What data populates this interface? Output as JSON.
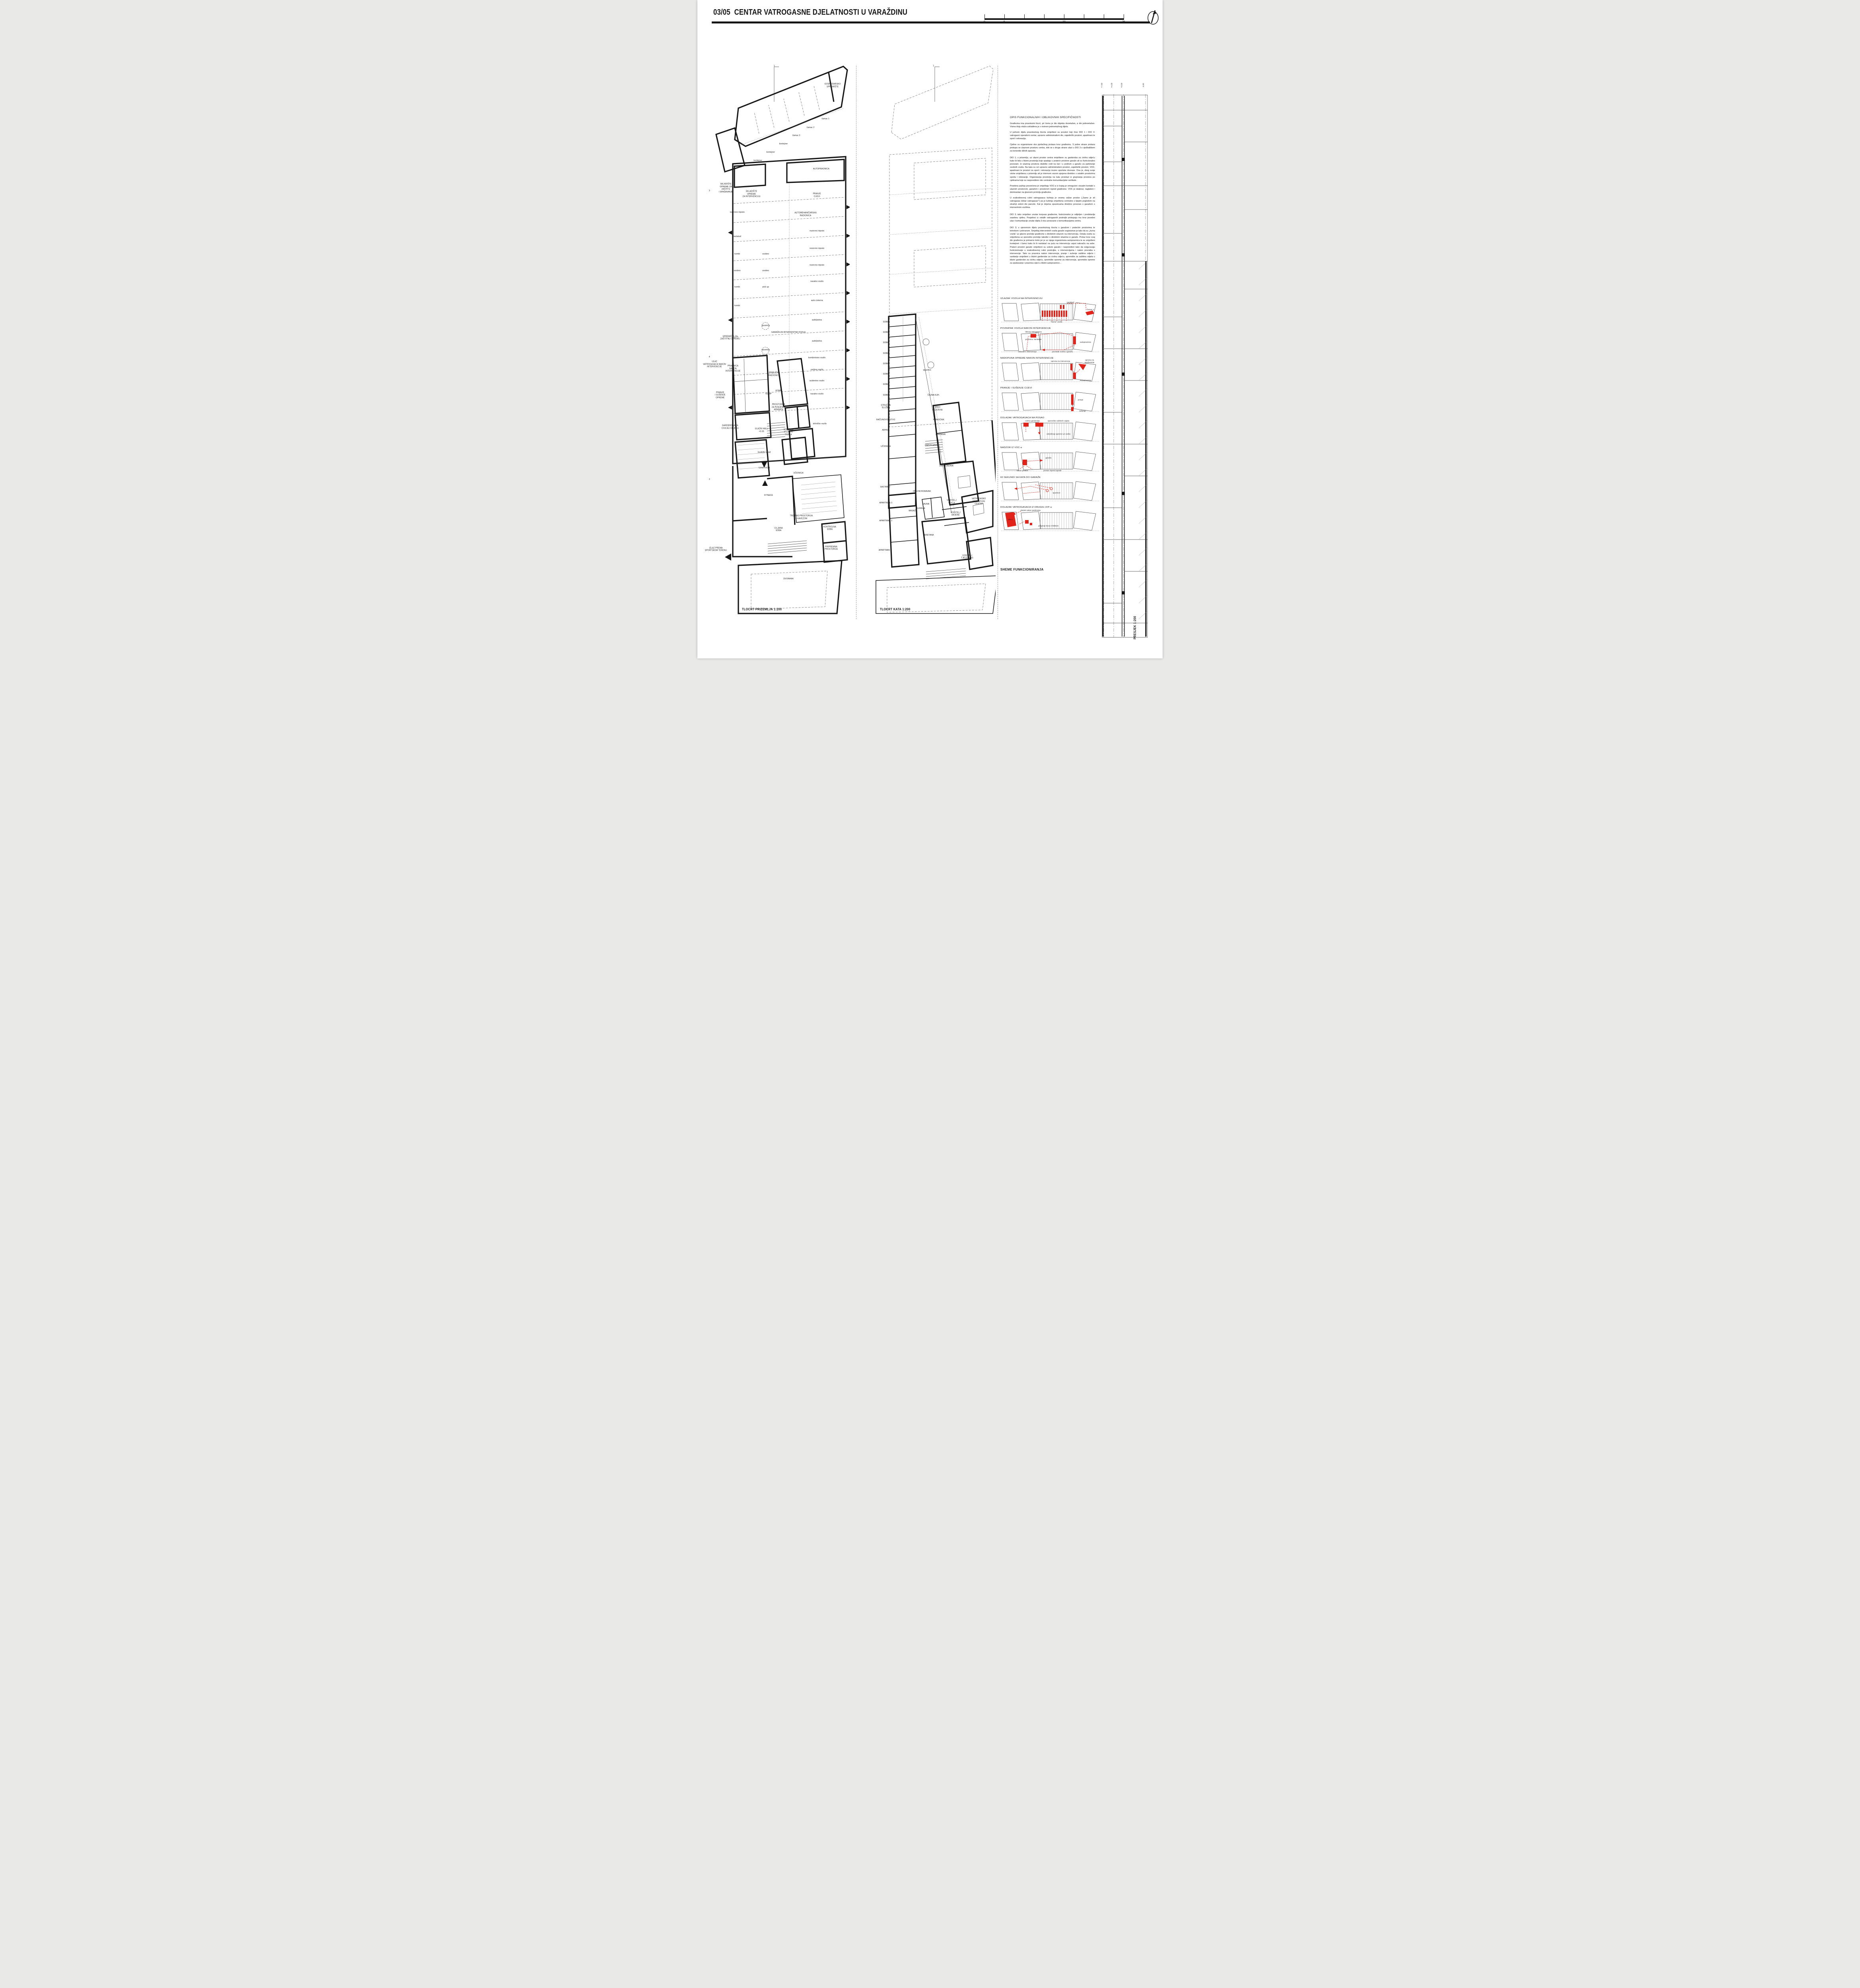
{
  "header": {
    "sheet_no": "03/05",
    "title": "CENTAR VATROGASNE DJELATNOSTI U VARAŽDINU",
    "scale_labels": [
      "0",
      "5",
      "20",
      "35"
    ]
  },
  "description": {
    "heading": "OPIS FUNKCIONALNIH I OBLIKOVNIH SPECIFIČNOSTI",
    "paragraphs": [
      "Građevina ima pravokutni tlocrt, pri čemu je dio objekta dvoetažan, a dio jednoetažan. Visina dviju etaža usklađena je s visinom jednoetažnog dijela.",
      "U južnom dijelu pravokutnog tlocrta smješteni su prostori koji čine DIO 1 i DIO 3: vatrogasni operativni centar, upravno administrativni dio, zajednički prostori, apartmani te sport i rekreacija.",
      "Cjeline su organizirane oko pješačkog prolaza kroz građevinu. S jedne strane prolaza pristupa se ulaznom prostoru centra, dok se s druge strane ulazi u DIO 3 s vježbalištem za korisnike dišnih aparata.",
      "DIO 1; u prizemlju, uz ulazni prostor centra smještene su garderoba za civilnu odjeću kako bi bila u blizini prostorija koje spadaju u prateće prostore garaže ali su funkcionalno povezani. Iz ulaznog prostora stubište vodi na kat i u podrum u garažu za parkiranje osobnih vozila. Na katu su svi upravno administrativni prostori, zajednički prostori, VOC, apartmani te prostori za sport i rekreaciju izuzev sportske dvorane. Ona je, zbog svoje visine smještena u prizemlju ali je internom vezom spojena direktno s ostalim prostorima sporta i rekreacije. Organizacija prostorija na katu proizlazi iz grupiranja prostora po cjelinama koje su raspoređene oko centralne komunikacijske vertikale.",
      "Posebna pažnja posvećena je smještaju VOC-a iz kojeg je omogućen vizualni kontakt s ulaznim prostorom, garažom i prostorom ispred građevine. VOC je istaknut, naglašen i dominantan na glavnom pročelju građevine.",
      "U svakodnevnoj rutini vatrogasaca kuhinja je veoma važan prostor („Samo je sit vatrogasac dobar vatrogasac!“) pa je kuhinja smještena centralno s lijepim pogledom na stražnji zeleni dio parcele. Kat je dvjema spusnicama direktno povezan s garažom s interventnim vozilima.",
      "DIO 3, iako smješten unutar korpusa građevine, funkcionalno je odijeljen i predstavlja zasebnu cjelinu. Posjetioci iz ostalih vatrogasnih postrojbi pristupaju mu kroz posebni ulaz i komunikacije unutar dijela 3 nisu povezane s komunikacijama centra.",
      "DIO 3; u sjevernom dijelu pravokutnog tlocrta s garažom i pratećim prostorima te tehnikom i pohranom. Smještaj interventnih vozila garaže organiziran je tako da su „žurna vozila“ uz glavno pročelje građevine s direktnim izlazom na intervenciju. Ostala vozila su smještena uz sporedno pročelje također s direktnim izlazima iz garaže. Prolaz kroz ovaj dio građevinu je primarno kolni jer je uz njega organizirana autopraonica te su smješteni kontejneri i čamci kako bi ih navlakač na putu na intervenciju usput nakvačio na sebe. Prateći prostori garaže smješteni su uokolo garaže i raspoređeni tako da osiguravaju funkcioniranje u svakodnevnoj rutini postrojbe, u intervencijama i nakon povratka s intervencije. Tako su praonica nakon intervencije, pranje i sušenje zaštitne odjeće i sanitarije smješteni u blizini garderobe za civilnu odjeću, spremište za zaštitna odjela u blizini garderobe za civilnu odjeću, spremište opreme za intervencije, spremište opreme za spašavanje i praonica cijevi u blizini autopraonice..."
    ]
  },
  "ground_plan": {
    "caption": "TLOCRT PRIZEMLJA 1:200",
    "labels": [
      {
        "t": "GOSPODARSKO\nSPREMIŠTE",
        "x": 88,
        "y": 4
      },
      {
        "t": "čamac 1",
        "x": 83,
        "y": 10
      },
      {
        "t": "čamac 2",
        "x": 72.5,
        "y": 11.6
      },
      {
        "t": "čamac 3",
        "x": 62.5,
        "y": 13.1
      },
      {
        "t": "kontejner",
        "x": 53.5,
        "y": 14.6
      },
      {
        "t": "kontejner",
        "x": 44.5,
        "y": 16.1
      },
      {
        "t": "kontejner",
        "x": 35.5,
        "y": 17.6
      },
      {
        "t": "SKLADIŠTE\nOPREME ZA\nZAŠTITU\nI SPAŠAVANJE",
        "x": 13,
        "y": 22.6
      },
      {
        "t": "AUTOPRAONICA",
        "x": 80,
        "y": 19.1
      },
      {
        "t": "SKLADIŠTE\nOPREME\nZA INTERVENCIJU",
        "x": 31,
        "y": 23.7
      },
      {
        "t": "PRANJE\nCIJEVI",
        "x": 77,
        "y": 23.9
      },
      {
        "t": "AUTOMEHANIČARSKA\nRADIONICA",
        "x": 69,
        "y": 27.4
      },
      {
        "t": "rezervno mjesto",
        "x": 21,
        "y": 27.0
      },
      {
        "t": "rezervno mjesto",
        "x": 77,
        "y": 30.4
      },
      {
        "t": "navlakač",
        "x": 21,
        "y": 31.4
      },
      {
        "t": "rezervno mjesto",
        "x": 77,
        "y": 33.6
      },
      {
        "t": "kombi",
        "x": 21,
        "y": 34.6
      },
      {
        "t": "osobno",
        "x": 41,
        "y": 34.6
      },
      {
        "t": "rezervno mjesto",
        "x": 77,
        "y": 36.6
      },
      {
        "t": "osobno",
        "x": 21,
        "y": 37.6
      },
      {
        "t": "osobno",
        "x": 41,
        "y": 37.6
      },
      {
        "t": "navalno vozilo",
        "x": 77,
        "y": 39.6
      },
      {
        "t": "kombi",
        "x": 21,
        "y": 40.6
      },
      {
        "t": "pick up",
        "x": 41,
        "y": 40.6
      },
      {
        "t": "auto cisterna",
        "x": 77,
        "y": 43.0
      },
      {
        "t": "kombi",
        "x": 21,
        "y": 44.0
      },
      {
        "t": "spusnica",
        "x": 41,
        "y": 47.6
      },
      {
        "t": "autoljestva",
        "x": 77,
        "y": 46.6
      },
      {
        "t": "GARAŽA ZA INTERVENTNA VOZILA",
        "x": 57,
        "y": 48.8
      },
      {
        "t": "SPREMIŠTE ZA\nZAŠTITNU OPREMU",
        "x": 16,
        "y": 49.8
      },
      {
        "t": "autoljestva",
        "x": 77,
        "y": 50.4
      },
      {
        "t": "spusnica",
        "x": 41,
        "y": 52.0
      },
      {
        "t": "kombinirano vozilo",
        "x": 77,
        "y": 53.4
      },
      {
        "t": "ULAZ\nVATROGASACA NAKON\nINTERVENCIJE",
        "x": 5,
        "y": 54.6
      },
      {
        "t": "PRAONICA\nNAKON\nINTERVENCIJE",
        "x": 18,
        "y": 55.4
      },
      {
        "t": "osobno vozilo",
        "x": 77,
        "y": 55.6
      },
      {
        "t": "PRIRUČNA\nRADIONICA",
        "x": 47,
        "y": 56.4
      },
      {
        "t": "acidentno vozilo",
        "x": 77,
        "y": 57.6
      },
      {
        "t": "KOMP",
        "x": 43,
        "y": 60.0
      },
      {
        "t": "KOMP",
        "x": 50,
        "y": 59.4
      },
      {
        "t": "PRANJE\nI SUŠENJE\nOPREME",
        "x": 9,
        "y": 60.2
      },
      {
        "t": "navalno vozilo",
        "x": 77,
        "y": 60.0
      },
      {
        "t": "PROSTORIJA\nZA PUNJENJE\nAPARATA",
        "x": 50,
        "y": 62.4
      },
      {
        "t": "GARDEROBA ZA\nCIVILNU ODJEĆU",
        "x": 16,
        "y": 66.0
      },
      {
        "t": "ULAZNI HALL\n+0.00",
        "x": 38,
        "y": 66.6
      },
      {
        "t": "VODITELJ\nVOZNOG\nPARKA",
        "x": 57,
        "y": 66.9
      },
      {
        "t": "tehničko vozilo",
        "x": 79,
        "y": 65.4
      },
      {
        "t": "GLAVNI ULAZ",
        "x": 40,
        "y": 70.6
      },
      {
        "t": "ULAZ DIO 3",
        "x": 40,
        "y": 73.4
      },
      {
        "t": "UČIONICA",
        "x": 64,
        "y": 74.4
      },
      {
        "t": "FITNESS",
        "x": 43,
        "y": 78.4
      },
      {
        "t": "TRENING PROSTORIJA\nS KAVEZOM",
        "x": 66,
        "y": 82.4
      },
      {
        "t": "CILJANA\nSOBA",
        "x": 50,
        "y": 84.6
      },
      {
        "t": "KONTROLNA\nSOBA",
        "x": 86,
        "y": 84.4
      },
      {
        "t": "PRIPREMNA\nPROSTORIJA",
        "x": 87,
        "y": 88.0
      },
      {
        "t": "IZLAZ PREMA\nSPORTSKOM TERENU",
        "x": 6,
        "y": 88.2
      },
      {
        "t": "DVORANA",
        "x": 57,
        "y": 93.6
      },
      {
        "t": "1",
        "x": 47,
        "y": 0.4
      },
      {
        "t": "3",
        "x": 1.5,
        "y": 23.1
      },
      {
        "t": "4",
        "x": 1.5,
        "y": 53.3
      },
      {
        "t": "2",
        "x": 1.5,
        "y": 75.5
      }
    ]
  },
  "floor_plan": {
    "caption": "TLOCRT KATA 1:200",
    "labels": [
      {
        "t": "SOBA",
        "x": 15,
        "y": 46.9
      },
      {
        "t": "SOBA",
        "x": 15,
        "y": 48.8
      },
      {
        "t": "SOBA",
        "x": 15,
        "y": 50.7
      },
      {
        "t": "SOBA",
        "x": 15,
        "y": 52.6
      },
      {
        "t": "SOBA",
        "x": 15,
        "y": 54.5
      },
      {
        "t": "SOBA",
        "x": 15,
        "y": 56.4
      },
      {
        "t": "SOBA",
        "x": 15,
        "y": 58.3
      },
      {
        "t": "SOBA",
        "x": 15,
        "y": 60.2
      },
      {
        "t": "spusnice",
        "x": 47,
        "y": 55.7
      },
      {
        "t": "STRUČNA\nSLUŽBA",
        "x": 15,
        "y": 62.3
      },
      {
        "t": "RAČUNOVODSTVO",
        "x": 15,
        "y": 64.7
      },
      {
        "t": "ARHIVA",
        "x": 15,
        "y": 66.6
      },
      {
        "t": "UČIONICA",
        "x": 15,
        "y": 69.5
      },
      {
        "t": "SASTANCI",
        "x": 14.5,
        "y": 76.9
      },
      {
        "t": "ČAJNA KUH.",
        "x": 52,
        "y": 60.2
      },
      {
        "t": "URED\nREZERVNI",
        "x": 55,
        "y": 62.7
      },
      {
        "t": "POMOĆNIK",
        "x": 56,
        "y": 64.7
      },
      {
        "t": "ZAMJENIK",
        "x": 57.5,
        "y": 67.4
      },
      {
        "t": "ZAPOSLENICI",
        "x": 50.5,
        "y": 69.3
      },
      {
        "t": "ZAPOVJEDNIK",
        "x": 62,
        "y": 73.1
      },
      {
        "t": "DNEVNI BORAVAK",
        "x": 43,
        "y": 77.7
      },
      {
        "t": "VODITELJ\nVOC-A",
        "x": 66,
        "y": 79.6
      },
      {
        "t": "VATROGASNO\nOPERATIVNI CENTAR",
        "x": 87,
        "y": 79.5
      },
      {
        "t": "KUHINJA",
        "x": 42,
        "y": 80.8
      },
      {
        "t": "VODITELJ\nSMJENE",
        "x": 69,
        "y": 81.8
      },
      {
        "t": "APARTMAN 3",
        "x": 15,
        "y": 79.8
      },
      {
        "t": "SAUNA",
        "x": 46,
        "y": 80.0
      },
      {
        "t": "MASAŽA",
        "x": 36,
        "y": 81.2
      },
      {
        "t": "APARTMAN 2",
        "x": 15,
        "y": 83.0
      },
      {
        "t": "TERETANA",
        "x": 48,
        "y": 85.6
      },
      {
        "t": "APARTMAN 1",
        "x": 14.5,
        "y": 88.4
      },
      {
        "t": "VODITELJ\nTJELESNOG",
        "x": 78,
        "y": 89.6
      },
      {
        "t": "1",
        "x": 52,
        "y": 0.4
      }
    ]
  },
  "section": {
    "caption": "PRESJEK 1:200",
    "levels": [
      "+7.60",
      "+4.30",
      "+0.00",
      "-3.20"
    ]
  },
  "schemes": {
    "caption": "SHEME FUNKCIONIRANJA",
    "items": [
      {
        "title": "IZLAZAK VOZILA NA INTERVENCIJU",
        "labels": [
          {
            "t": "navlakač",
            "x": 70,
            "y": 8
          },
          {
            "t": "čamac 1",
            "x": 90,
            "y": 40
          },
          {
            "t": "\"žurna\" vozila",
            "x": 56,
            "y": 96
          }
        ]
      },
      {
        "title": "POVRATAK VOZILA NAKON INTERVENCIJE",
        "labels": [
          {
            "t": "iskrcaj vatrogasaca",
            "x": 33,
            "y": 6
          },
          {
            "t": "praonica, sanitarije",
            "x": 33,
            "y": 40
          },
          {
            "t": "autopraonica",
            "x": 85,
            "y": 52
          },
          {
            "t": "dolazak s intervencije",
            "x": 27,
            "y": 96
          },
          {
            "t": "povratak vozila u garažu",
            "x": 62,
            "y": 96
          }
        ]
      },
      {
        "title": "NADOPUNA OPREME NAKON INTERVENCIJE",
        "labels": [
          {
            "t": "oprema za intervenciju",
            "x": 60,
            "y": 4
          },
          {
            "t": "oprema za spašavanje",
            "x": 89,
            "y": 4
          },
          {
            "t": "autopraonica",
            "x": 85,
            "y": 90
          }
        ]
      },
      {
        "title": "PRANJE I SUŠENJE CIJEVI",
        "labels": [
          {
            "t": "pranje",
            "x": 80,
            "y": 44
          },
          {
            "t": "sušenje",
            "x": 82,
            "y": 94
          }
        ]
      },
      {
        "title": "DOLAZAK VATROGASACA NA POSAO",
        "labels": [
          {
            "t": "civilna garderoba",
            "x": 32,
            "y": 4
          },
          {
            "t": "spremište zaštitnih odjela",
            "x": 58,
            "y": 4
          },
          {
            "t": "odnošenje opreme uz vozila",
            "x": 58,
            "y": 64
          }
        ]
      },
      {
        "title": "NADZOR IZ VOC-a",
        "labels": [
          {
            "t": "garaža",
            "x": 48,
            "y": 36
          },
          {
            "t": "ulazni prostor",
            "x": 22,
            "y": 94
          },
          {
            "t": "prostor ispred zgrade",
            "x": 52,
            "y": 94
          }
        ]
      },
      {
        "title": "60 SEKUNDI SA KATA DO GARAŽE",
        "labels": [
          {
            "t": "spusnice",
            "x": 56,
            "y": 60
          }
        ]
      },
      {
        "title": "DOLAZAK VATROGASACA IZ DRUGIH JVP-a",
        "labels": [
          {
            "t": "ulazak nakon parkiranja",
            "x": 30,
            "y": 4
          },
          {
            "t": "dio 3",
            "x": 10,
            "y": 46
          },
          {
            "t": "punjenje boca s kisikom",
            "x": 48,
            "y": 74
          }
        ]
      }
    ]
  }
}
